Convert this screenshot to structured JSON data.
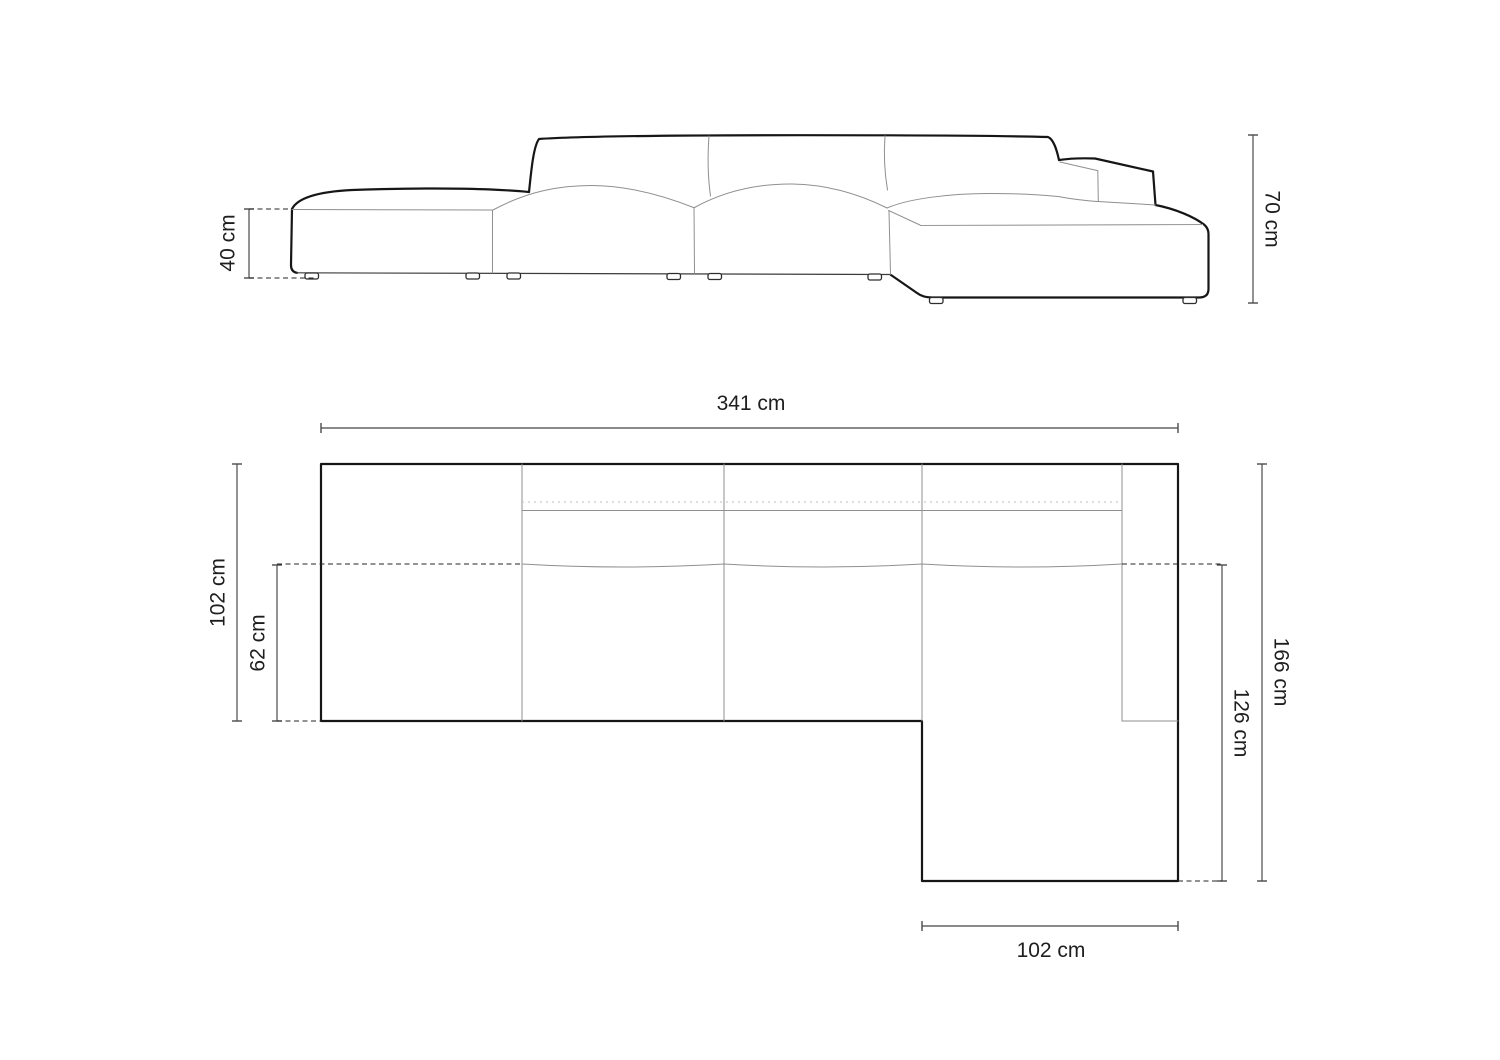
{
  "diagram": {
    "type": "furniture-dimension-drawing",
    "subject": "modular-sofa-with-open-end-and-right-chaise",
    "background": "#ffffff",
    "colors": {
      "outline": "#161616",
      "thin_line": "#8f8f8f",
      "dimension_line": "#4a4a4a",
      "dimension_line_light": "#7a7a7a",
      "dashed_line": "#242424",
      "text": "#1e1e1e"
    },
    "front_view": {
      "dimensions": {
        "seat_height": {
          "label": "40 cm"
        },
        "total_height": {
          "label": "70 cm"
        }
      }
    },
    "plan_view": {
      "dimensions": {
        "total_width": {
          "label": "341 cm"
        },
        "body_depth": {
          "label": "102 cm"
        },
        "seat_depth": {
          "label": "62 cm"
        },
        "total_depth": {
          "label": "166 cm"
        },
        "chaise_depth": {
          "label": "126 cm"
        },
        "chaise_width": {
          "label": "102 cm"
        }
      }
    }
  }
}
